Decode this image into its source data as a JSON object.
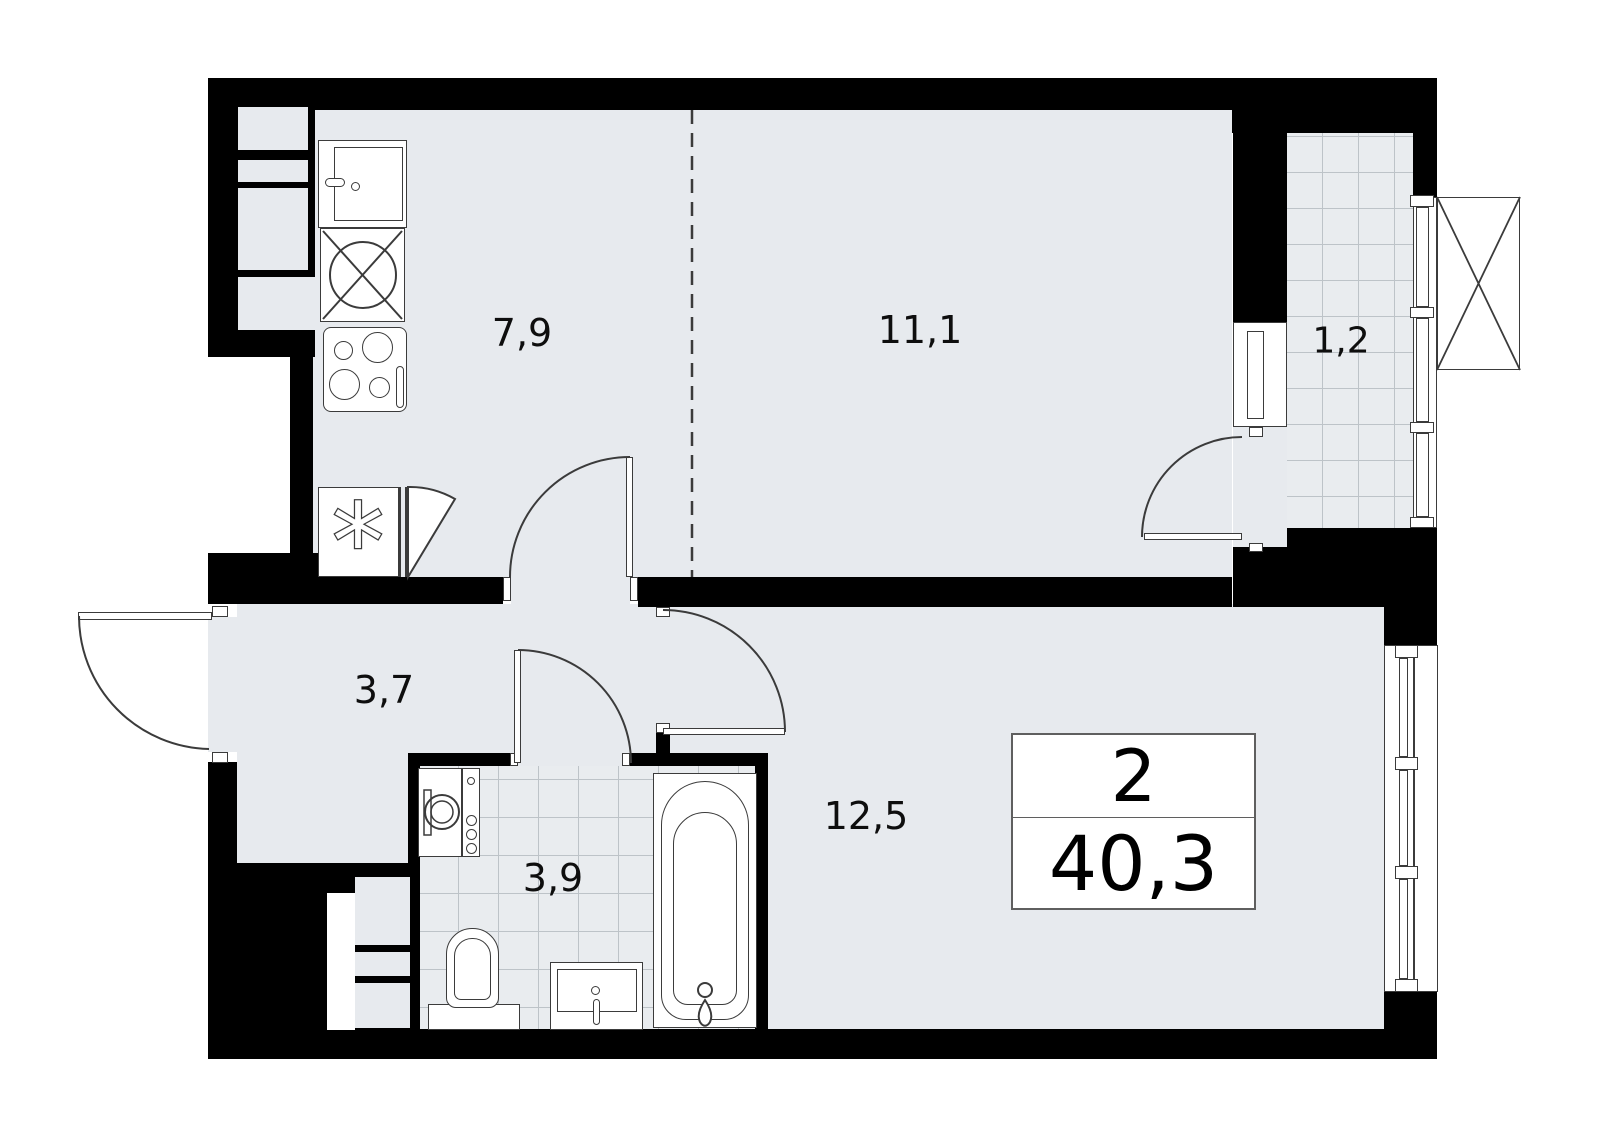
{
  "plan": {
    "type": "apartment-floor-plan",
    "rooms": [
      {
        "id": "kitchen",
        "area_label": "7,9"
      },
      {
        "id": "living-room",
        "area_label": "11,1"
      },
      {
        "id": "balcony",
        "area_label": "1,2"
      },
      {
        "id": "hallway",
        "area_label": "3,7"
      },
      {
        "id": "bathroom",
        "area_label": "3,9"
      },
      {
        "id": "bedroom",
        "area_label": "12,5"
      }
    ],
    "summary": {
      "rooms_count": "2",
      "total_area": "40,3"
    },
    "colors": {
      "wall": "#000000",
      "floor": "#e7eaee",
      "tile_line": "#bdc3c8",
      "background": "#ffffff"
    }
  }
}
